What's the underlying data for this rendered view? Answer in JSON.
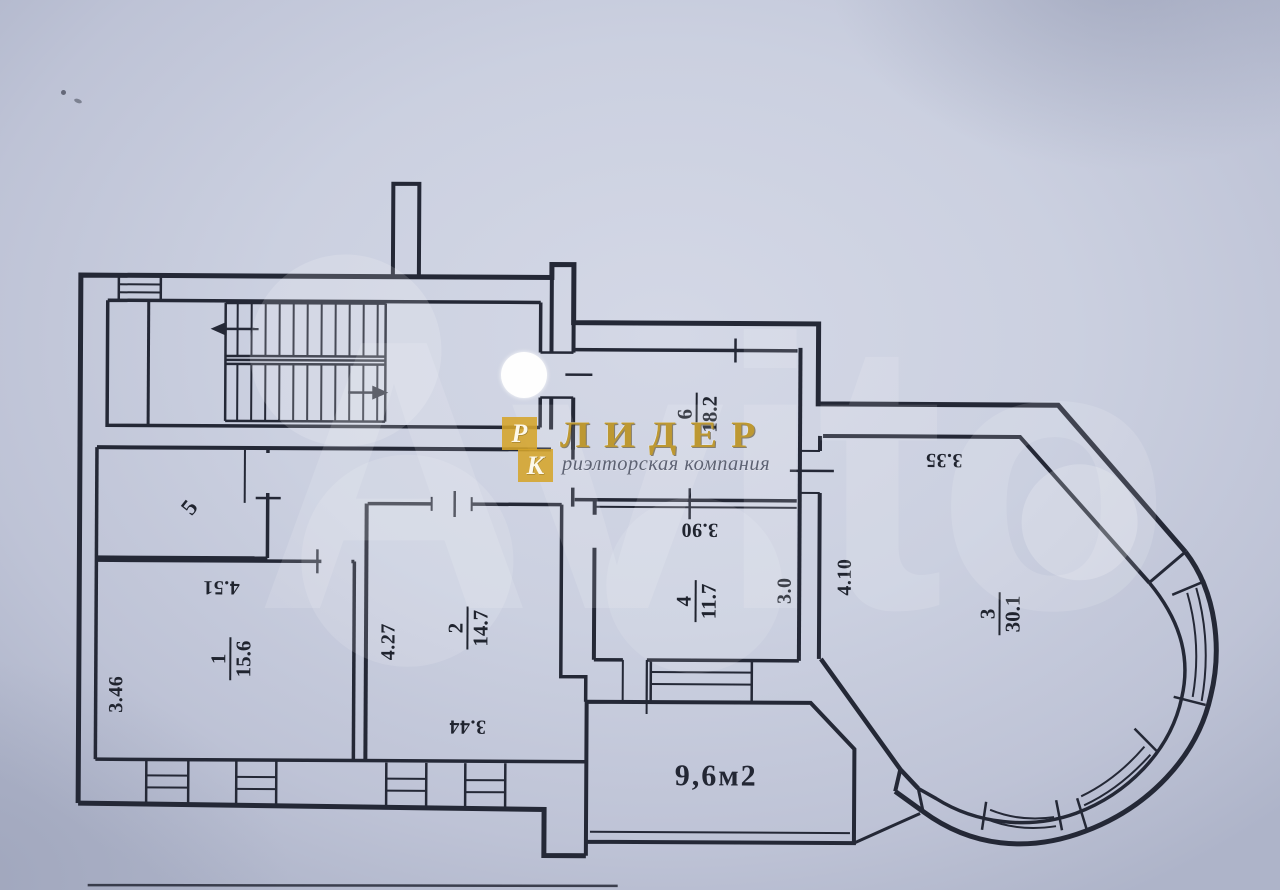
{
  "document": {
    "kind": "scanned apartment floor plan",
    "paper_color": "#cbd0e0",
    "ink_color": "#242836"
  },
  "watermark": {
    "text": "Avito"
  },
  "logo": {
    "mark_top": "Р",
    "mark_bottom": "К",
    "title": "ЛИДЕР",
    "subtitle": "риэлторская компания",
    "gold": "#d5a42a"
  },
  "rooms": [
    {
      "number": "6",
      "area": "18.2"
    },
    {
      "number": "5",
      "area": ""
    },
    {
      "number": "1",
      "area": "15.6"
    },
    {
      "number": "2",
      "area": "14.7"
    },
    {
      "number": "4",
      "area": "11.7"
    },
    {
      "number": "3",
      "area": "30.1"
    }
  ],
  "dimensions": [
    {
      "id": "dim-room1-width",
      "value": "4.51"
    },
    {
      "id": "dim-room1-depth",
      "value": "3.46"
    },
    {
      "id": "dim-room2-depth",
      "value": "4.27"
    },
    {
      "id": "dim-room2-width",
      "value": "3.44"
    },
    {
      "id": "dim-room4-width",
      "value": "3.90"
    },
    {
      "id": "dim-room4-depth",
      "value": "3.0"
    },
    {
      "id": "dim-room3-depth",
      "value": "4.10"
    },
    {
      "id": "dim-room3-width",
      "value": "3.35"
    }
  ],
  "balcony": {
    "label": "9,6м2"
  }
}
